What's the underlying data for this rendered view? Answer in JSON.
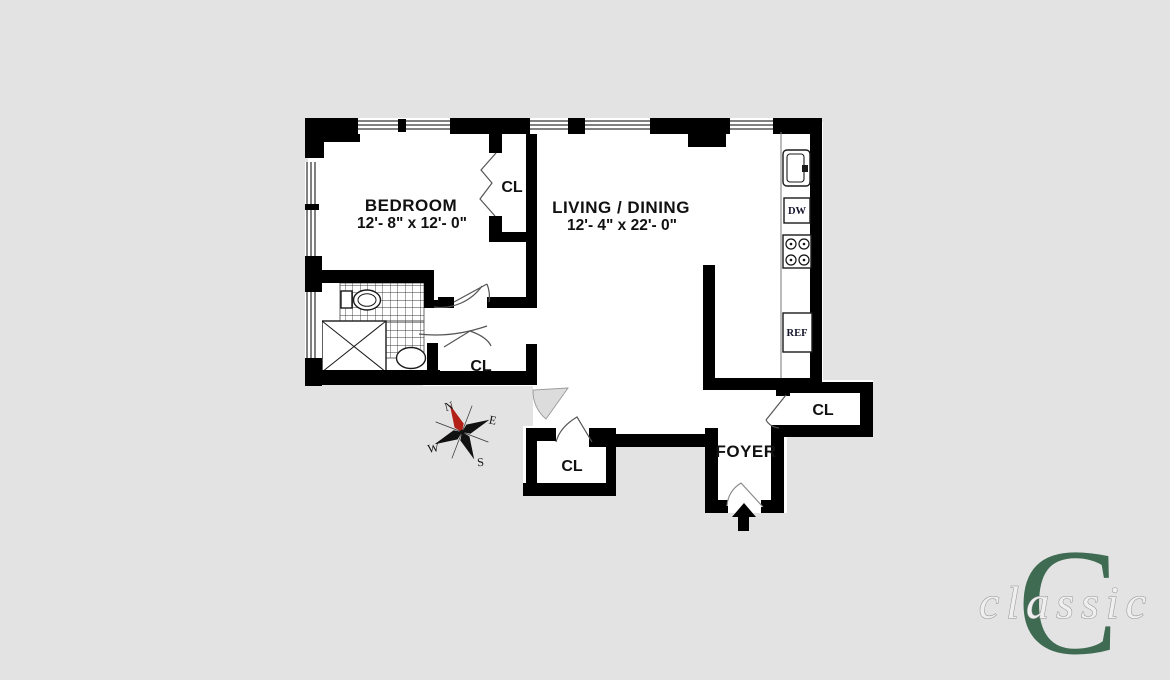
{
  "rooms": {
    "bedroom": {
      "name": "BEDROOM",
      "dims": "12'- 8\" x 12'- 0\""
    },
    "living": {
      "name": "LIVING / DINING",
      "dims": "12'- 4\" x 22'- 0\""
    },
    "foyer": {
      "name": "FOYER"
    }
  },
  "closets": {
    "bedroom_closet": "CL",
    "hall_closet": "CL",
    "entry_closet": "CL",
    "foyer_closet": "CL"
  },
  "kitchen": {
    "dishwasher_label": "DW",
    "refrigerator_label": "REF"
  },
  "compass": {
    "north": "N",
    "east": "E",
    "south": "S",
    "west": "W"
  },
  "logo": {
    "monogram": "C",
    "wordmark": "classic",
    "color": "#3f6b53"
  },
  "colors": {
    "background": "#e3e3e3",
    "walls": "#000000",
    "floor": "#ffffff",
    "compass_needle": "#b32017"
  }
}
